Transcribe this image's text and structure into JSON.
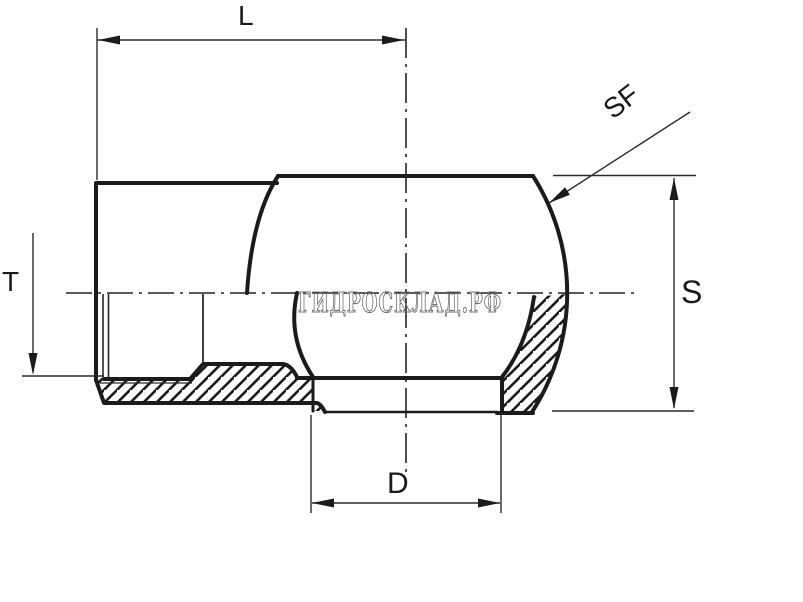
{
  "app": {
    "type": "engineering-drawing",
    "subject": "hydraulic cap fitting cross-section",
    "background": "#ffffff"
  },
  "labels": {
    "L": "L",
    "SF": "SF",
    "T": "T",
    "S": "S",
    "D": "D"
  },
  "watermark": {
    "text": "ГИДРОСКЛАД.РФ",
    "color": "#6e6e6e"
  },
  "colors": {
    "outline": "#1b1b1b",
    "thin_line": "#2a2a2a",
    "centerline": "#222222",
    "label": "#1a1a1a",
    "hatch": "#1b1b1b"
  }
}
